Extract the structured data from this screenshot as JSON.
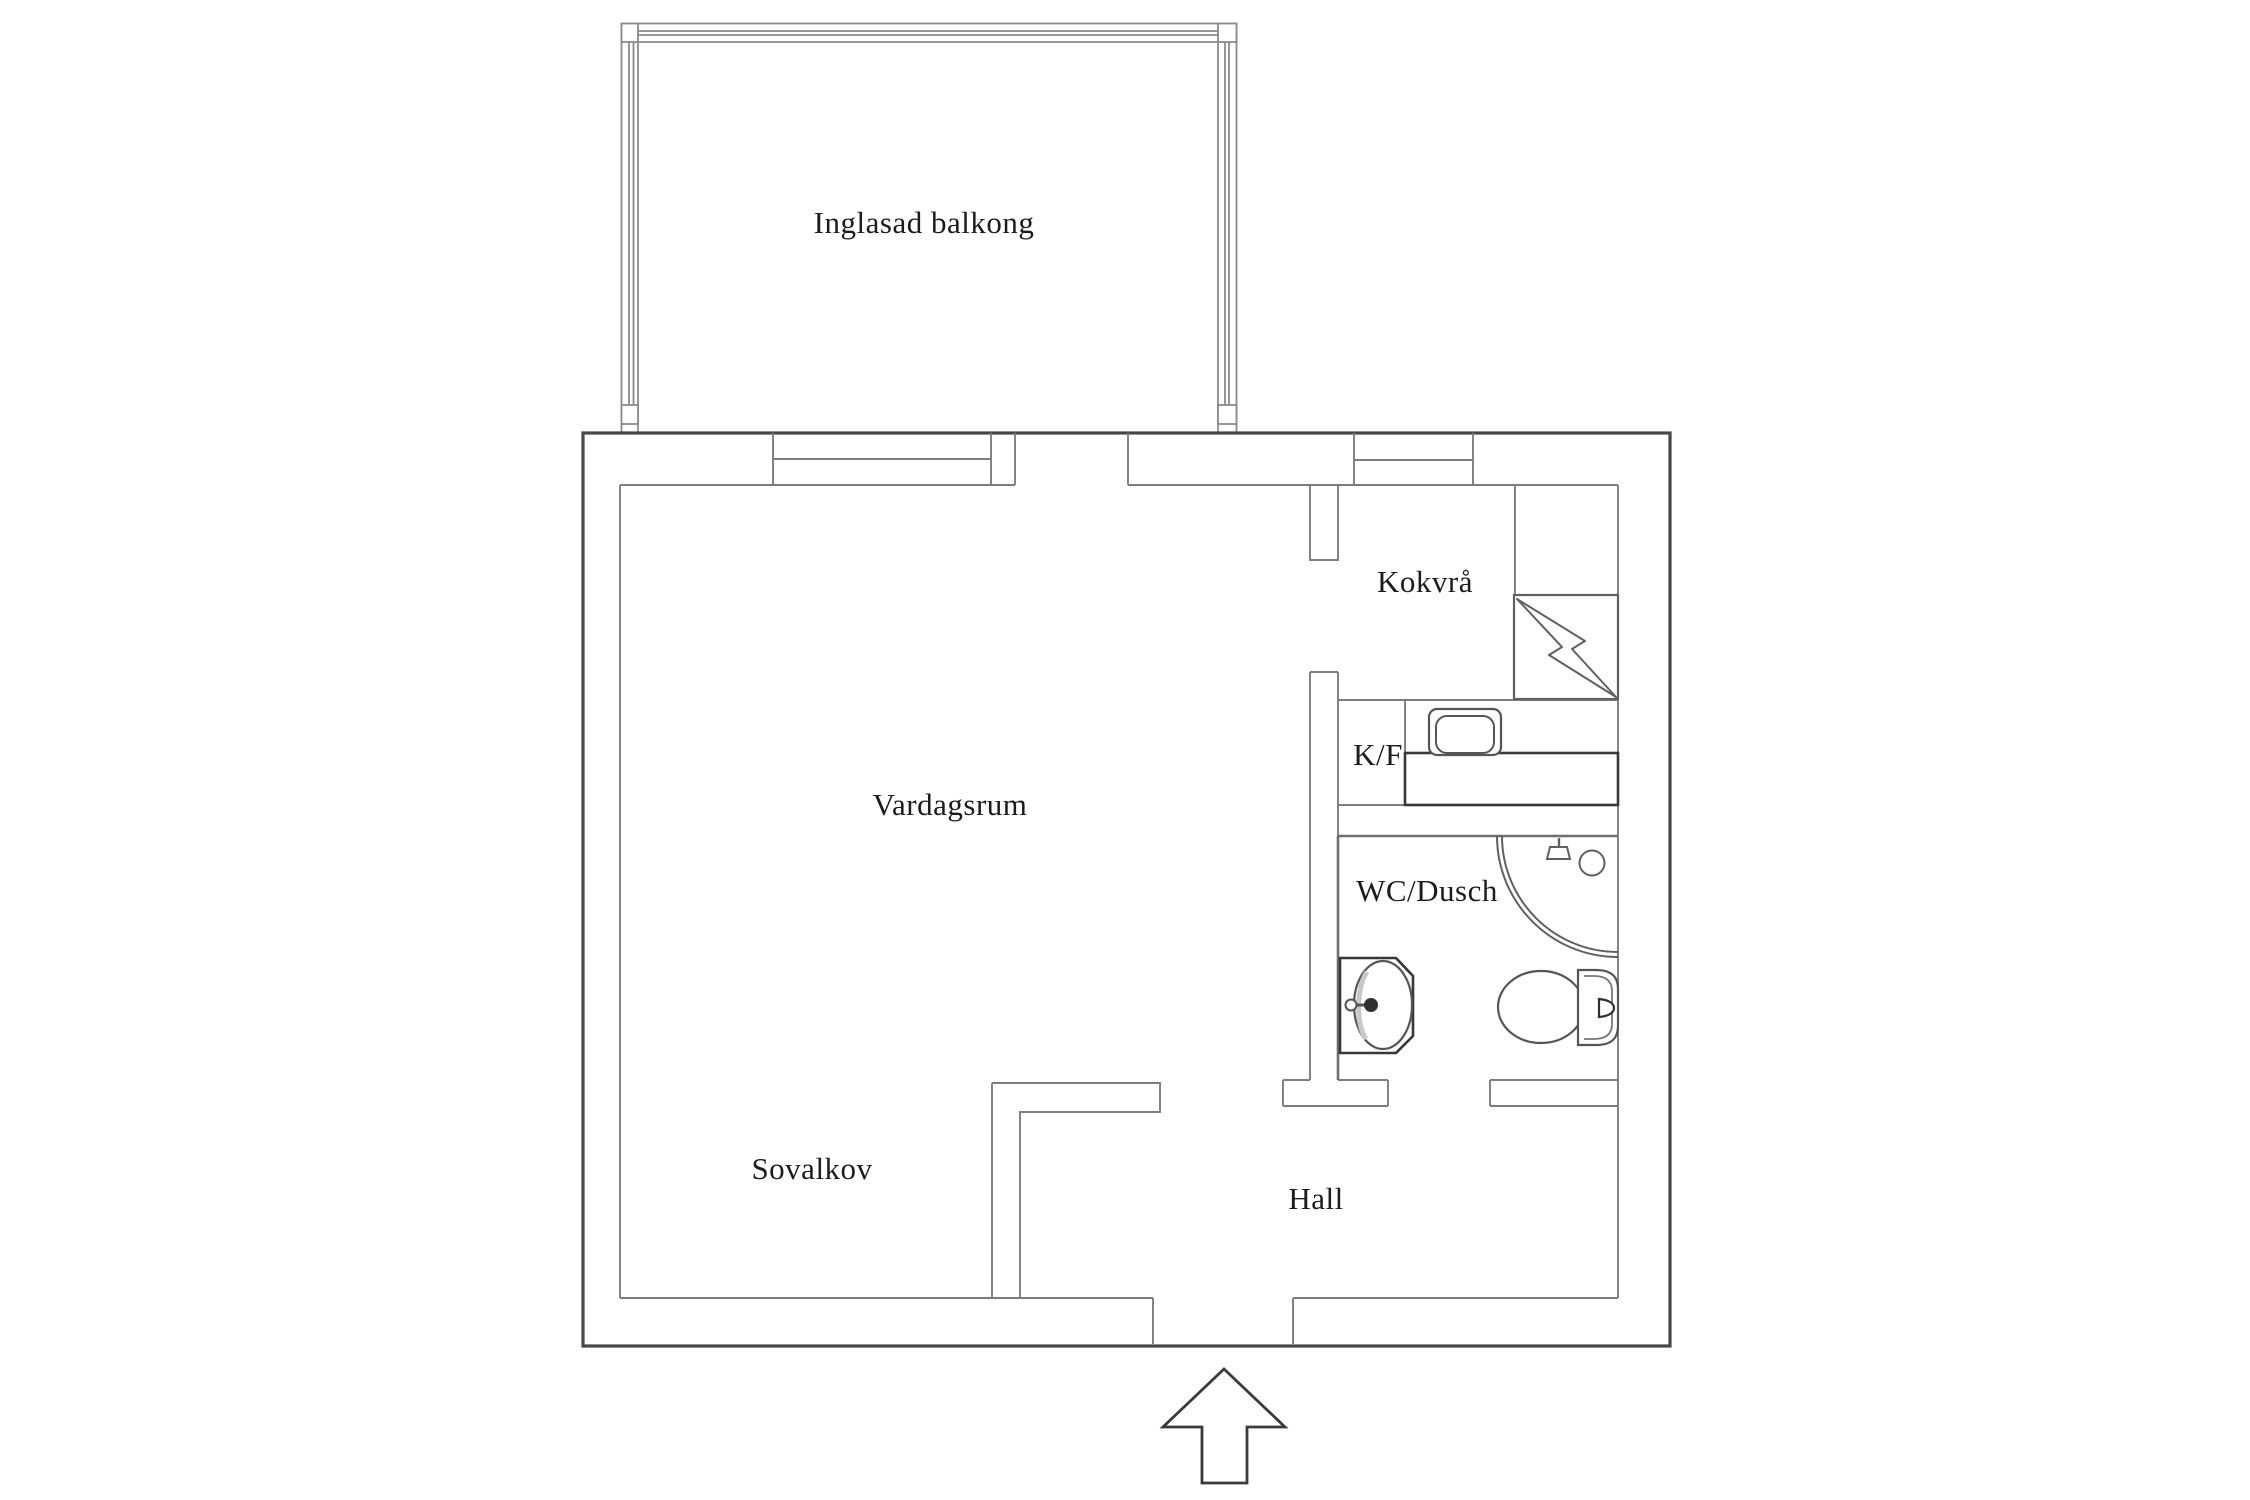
{
  "floorplan": {
    "type": "apartment-floor-plan",
    "background": "#ffffff",
    "rooms": [
      {
        "id": "glazed-balcony",
        "label": "Inglasad balkong"
      },
      {
        "id": "living-room",
        "label": "Vardagsrum"
      },
      {
        "id": "kitchenette",
        "label": "Kokvrå"
      },
      {
        "id": "fridge-freezer",
        "label": "K/F"
      },
      {
        "id": "wc-shower",
        "label": "WC/Dusch"
      },
      {
        "id": "sleeping-alcove",
        "label": "Sovalkov"
      },
      {
        "id": "hall",
        "label": "Hall"
      }
    ],
    "fixtures": [
      "stove-icon",
      "kitchen-sink-icon",
      "tall-cabinet",
      "kitchen-counter",
      "corner-shower-icon",
      "shower-head-icon",
      "floor-drain-icon",
      "washbasin-icon",
      "faucet-icon",
      "toilet-icon",
      "entrance-arrow-icon"
    ],
    "colors": {
      "outer_wall": "#474747",
      "interior_line": "#7d7d7d",
      "fixture_line": "#606060",
      "heavy_line": "#383838",
      "label_text": "#1c1c1c",
      "background": "#ffffff"
    }
  }
}
